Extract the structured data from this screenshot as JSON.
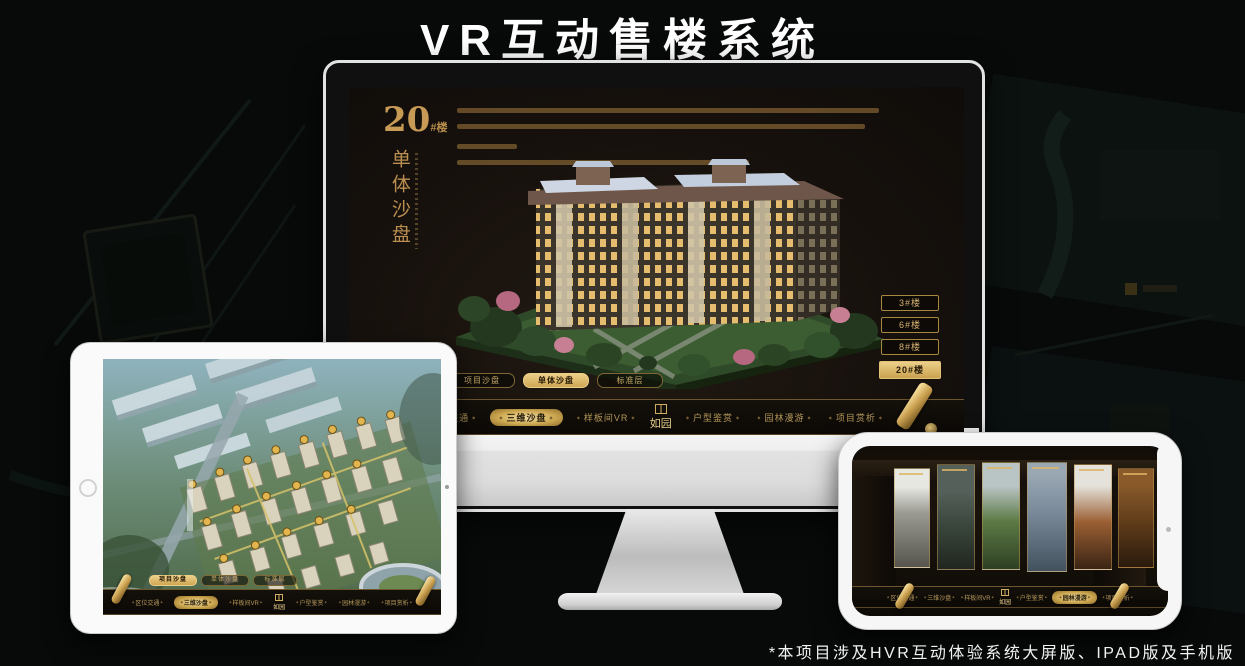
{
  "brand": {
    "logo": "如园"
  },
  "page": {
    "title": "VR互动售楼系统",
    "footnote": "*本项目涉及HVR互动体验系统大屏版、IPAD版及手机版"
  },
  "colors": {
    "gold": "#c9a365",
    "gold_bright": "#ecd08a",
    "screen_bg": "#17110d",
    "nav_bg": "#0d0a07"
  },
  "monitor": {
    "heading": {
      "number": "20",
      "suffix": "#楼",
      "subtitle_vertical": "单体沙盘"
    },
    "floor_buttons": [
      {
        "label": "3#楼",
        "active": false
      },
      {
        "label": "6#楼",
        "active": false
      },
      {
        "label": "8#楼",
        "active": false
      },
      {
        "label": "20#楼",
        "active": true
      }
    ],
    "sub_tabs": [
      {
        "label": "项目沙盘",
        "active": false
      },
      {
        "label": "单体沙盘",
        "active": true
      },
      {
        "label": "标准层",
        "active": false
      }
    ],
    "nav_items": [
      {
        "label": "区位交通",
        "active": false
      },
      {
        "label": "三维沙盘",
        "active": true
      },
      {
        "label": "样板间VR",
        "active": false
      },
      {
        "label": "户型鉴赏",
        "active": false
      },
      {
        "label": "园林漫游",
        "active": false
      },
      {
        "label": "项目赏析",
        "active": false
      }
    ]
  },
  "tablet": {
    "sub_tabs": [
      {
        "label": "项目沙盘",
        "active": true
      },
      {
        "label": "单体沙盘",
        "active": false
      },
      {
        "label": "标准层",
        "active": false
      }
    ],
    "nav_items": [
      {
        "label": "区位交通",
        "active": false
      },
      {
        "label": "三维沙盘",
        "active": true
      },
      {
        "label": "样板间VR",
        "active": false
      },
      {
        "label": "户型鉴赏",
        "active": false
      },
      {
        "label": "园林漫游",
        "active": false
      },
      {
        "label": "项目赏析",
        "active": false
      }
    ]
  },
  "phone": {
    "nav_items": [
      {
        "label": "区位交通",
        "active": false
      },
      {
        "label": "三维沙盘",
        "active": false
      },
      {
        "label": "样板间VR",
        "active": false
      },
      {
        "label": "户型鉴赏",
        "active": false
      },
      {
        "label": "园林漫游",
        "active": true
      },
      {
        "label": "项目赏析",
        "active": false
      }
    ]
  }
}
